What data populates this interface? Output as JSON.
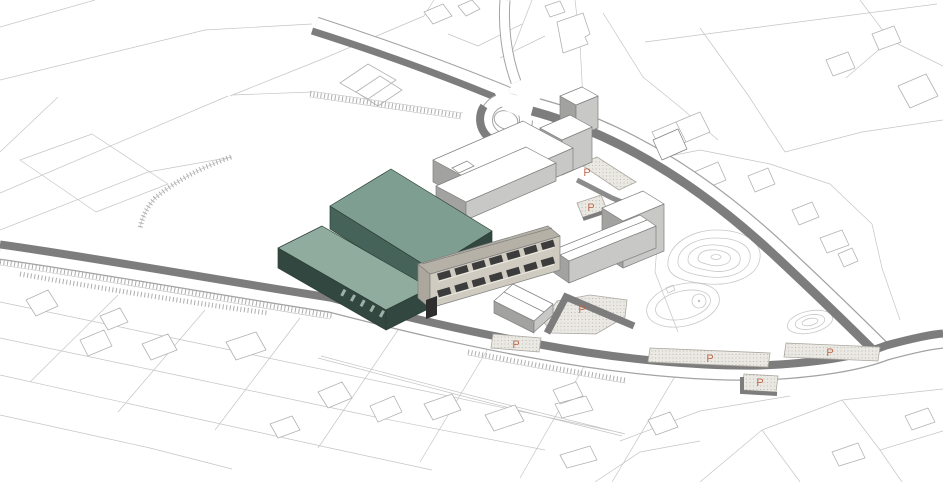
{
  "canvas": {
    "width": 943,
    "height": 482
  },
  "palette": {
    "background": "#ffffff",
    "parcel_line": "#c5c5c5",
    "house_line": "#b2b2b2",
    "contour_line": "#c8c8c8",
    "hatch_line": "#adadad",
    "road_casing": "#a3a3a3",
    "road_surface": "#ffffff",
    "road_bank": "#7d7d7d",
    "retaining_wall": "#8c8c8c",
    "parking_fill": "#eae8e3",
    "parking_dot": "#b7b3aa",
    "parking_border": "#aaa79f",
    "parking_label": "#bd6244",
    "building_line": "#7f7f7f",
    "white_roof": "#ffffff",
    "white_wall_light": "#c8c8c6",
    "white_wall_shade": "#a2a2a0",
    "teal_line": "#2b3e36",
    "teal_roof_upper": "#7f9e92",
    "teal_roof_lower": "#90ac9f",
    "teal_wall": "#46635a",
    "teal_wall_dark": "#324740",
    "teal_window": "#9cb2a8",
    "beige_roof": "#b5b1a6",
    "beige_wall": "#cfcbc0",
    "beige_wall_end": "#aba79c",
    "window_dark": "#3c3c3c",
    "sill_light": "#ece9e1",
    "door_dark": "#2e2e2e"
  },
  "markers": {
    "parking_label": "P",
    "positions": [
      {
        "x": 587,
        "y": 176
      },
      {
        "x": 591,
        "y": 211
      },
      {
        "x": 582,
        "y": 313
      },
      {
        "x": 516,
        "y": 348
      },
      {
        "x": 710,
        "y": 362
      },
      {
        "x": 830,
        "y": 356
      },
      {
        "x": 760,
        "y": 386
      }
    ]
  }
}
